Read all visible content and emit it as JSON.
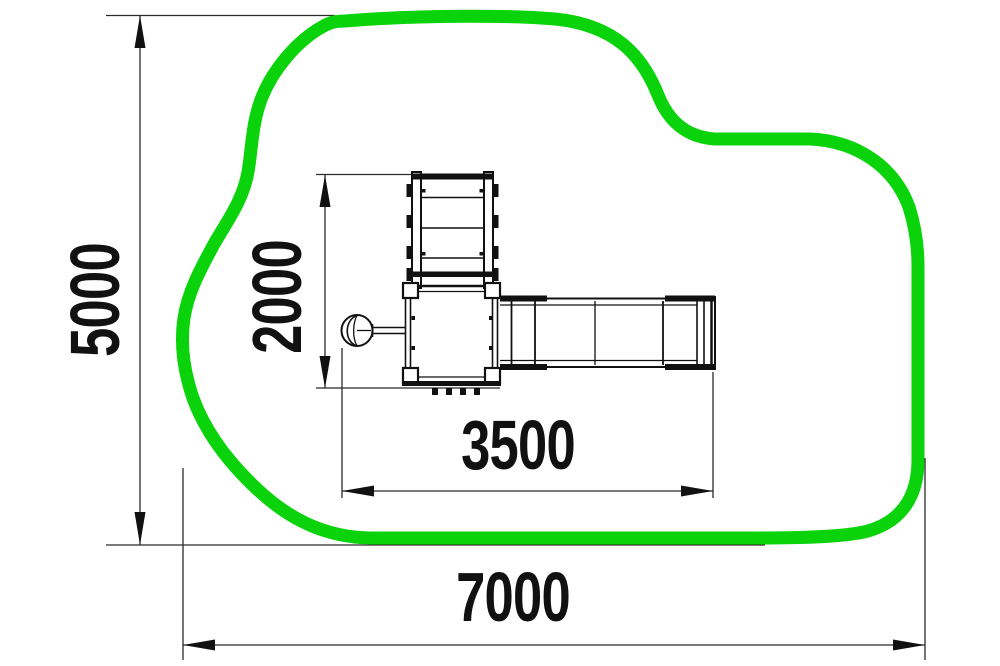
{
  "diagram": {
    "type": "playground-equipment-plan-view",
    "labels": {
      "site_height_mm": "5000",
      "equipment_depth_mm": "2000",
      "equipment_length_mm": "3500",
      "site_width_mm": "7000"
    },
    "colors": {
      "safety_zone_outline": "#0bd30b",
      "equipment_line": "#111111",
      "dimension_line": "#2b2b2b",
      "label_text": "#111111"
    }
  }
}
